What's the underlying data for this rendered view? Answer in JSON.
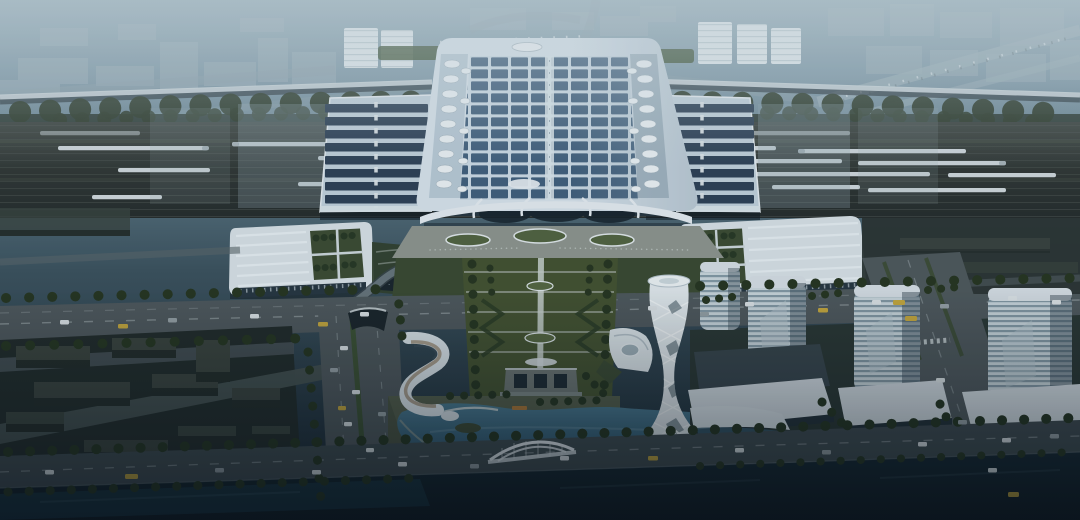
{
  "scene": {
    "type": "architectural-aerial-rendering",
    "time_of_day": "dusk",
    "subject": "Aerial dusk rendering of a high-speed railway station complex: solar-panel arched roof, flanking platform canopies over a rail yard with white trains, green-roof wing buildings, landscaped central axis leading to a lake with an arch bridge, a white spiral lattice tower, louvered residential towers with podiums, low-rise blocks and a canal in the foreground",
    "elements": [
      "hazy-distant-city",
      "elevated-highways",
      "tree-belt",
      "railway-yard",
      "white-trains",
      "platform-canopies",
      "station-solar-roof",
      "teardrop-skylights",
      "station-facade",
      "green-roof-wing-buildings",
      "forecourt-plaza",
      "landscaped-axis",
      "axis-pavilion",
      "arterial-road",
      "boulevard-with-tunnel-portal",
      "s-ribbon-building",
      "triangle-pavilion",
      "lake",
      "arch-bridge",
      "spiral-lattice-tower",
      "sail-canopies",
      "louvered-towers",
      "podium-buildings",
      "low-rise-blocks",
      "lakeside-road",
      "canal"
    ]
  },
  "palette": {
    "sky_top": "#93abb6",
    "sky_upper": "#7f99a7",
    "sky_mid": "#5d7885",
    "sky_low": "#3c525d",
    "sky_dark": "#16232c",
    "haze": "#d7e4e9",
    "city_block": "#9db0b9",
    "city_white": "#e3ebee",
    "tree_dark": "#26351f",
    "tree_belt": "#2d3b2a",
    "rail_bed_top": "#3d443f",
    "rail_bed_bottom": "#262c2b",
    "rail_line": "#4a524d",
    "train_white": "#d2dadd",
    "canopy_deck": "#c3d2dc",
    "canopy_slat": "#2e4155",
    "roof_white": "#d9e4ec",
    "roof_slope": "#b6c8d4",
    "solar_panel": "#42607c",
    "glass_dark": "#27363f",
    "wing_roof": "#d9e2e7",
    "courtyard_green": "#3c4b31",
    "plaza_gray": "#8f958e",
    "lawn_green": "#44522f",
    "path_light": "#9aa396",
    "road_gray": "#4f585b",
    "lane_mark": "#a9b3b5",
    "car_white": "#dfe5e7",
    "car_gray": "#98a2a6",
    "taxi_yellow": "#c8a93c",
    "lake_top": "#4a7a90",
    "lake_bottom": "#2a5066",
    "shore_green": "#545e49",
    "tower_white": "#e2e9ec",
    "tower_louver_light": "#cbd7dc",
    "tower_louver_dark": "#8499a4",
    "podium_roof": "#d7dfe4",
    "block_dark": "#232b27",
    "block_top": "#3a433c",
    "canal_top": "#16272f",
    "canal_bottom": "#0d171e",
    "vignette": "#081018",
    "dock_orange": "#b27836",
    "sail_glass": "#35586a"
  }
}
